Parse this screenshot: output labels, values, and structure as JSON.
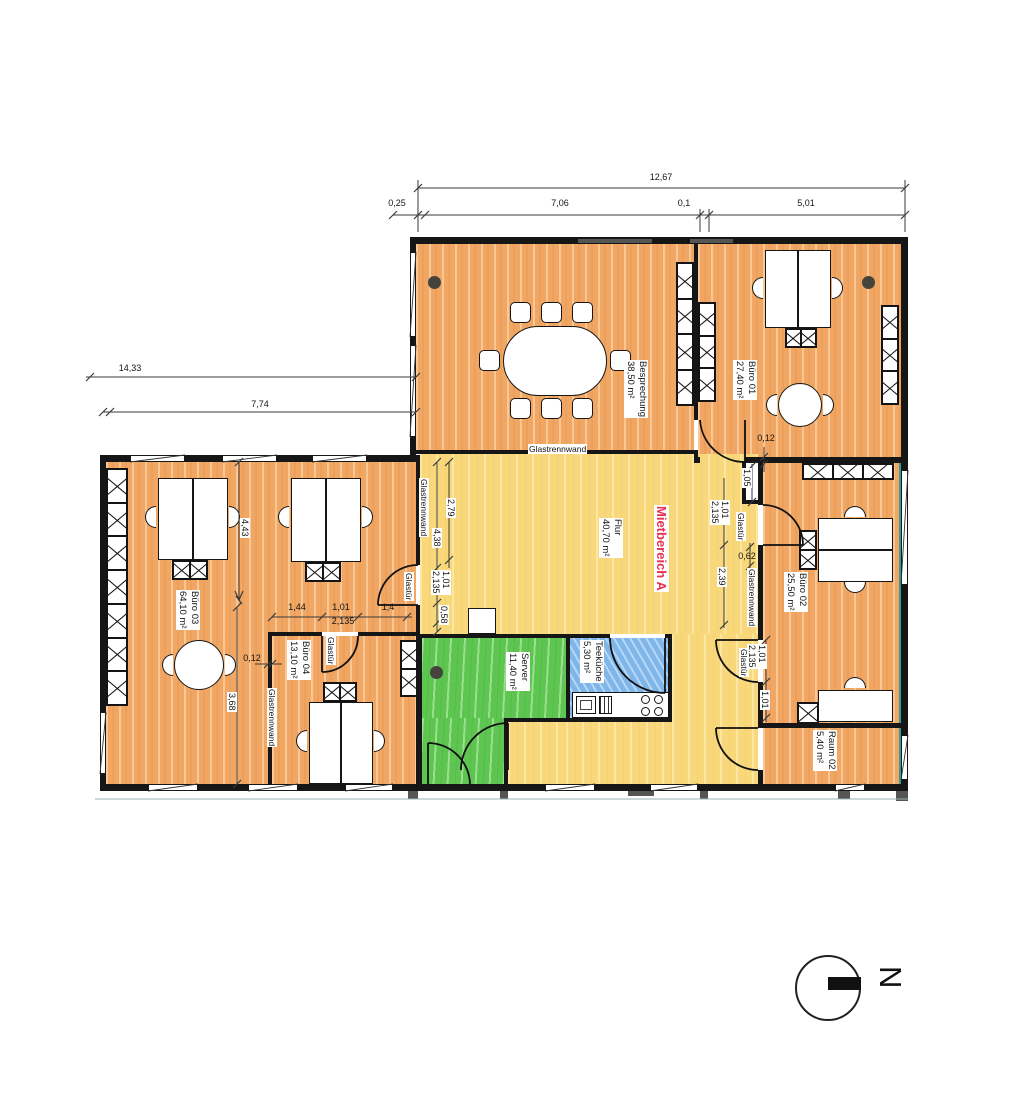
{
  "rooms": {
    "besprechung": {
      "name": "Besprechung",
      "area": "38,50 m²"
    },
    "buero01": {
      "name": "Büro 01",
      "area": "27,40 m²"
    },
    "buero02": {
      "name": "Büro 02",
      "area": "25,50 m²"
    },
    "buero03": {
      "name": "Büro 03",
      "area": "64,10 m²"
    },
    "buero04": {
      "name": "Büro 04",
      "area": "13,10 m²"
    },
    "flur": {
      "name": "Flur",
      "area": "40,70 m²"
    },
    "server": {
      "name": "Server",
      "area": "11,40 m²"
    },
    "teekueche": {
      "name": "Teeküche",
      "area": "5,30 m²"
    },
    "raum02": {
      "name": "Raum 02",
      "area": "5,40 m²"
    }
  },
  "zone": {
    "label": "Mietbereich A",
    "color": "#e63054"
  },
  "labels": {
    "glass_wall": "Glastrennwand",
    "glass_door": "Glastür"
  },
  "dims": {
    "top": {
      "total": "12,67",
      "segs": [
        "0,25",
        "7,06",
        "0,1",
        "5,01"
      ]
    },
    "left": [
      "14,33",
      "7,74"
    ],
    "flur_west": [
      "2,79",
      "4,38",
      "1,01",
      "2,135",
      "0,58"
    ],
    "flur_east": [
      "1,01",
      "2,135",
      "2,39"
    ],
    "niche": [
      "0,12",
      "1,05"
    ],
    "b02_west": [
      "0,62",
      "1,01",
      "2,135",
      "1,01"
    ],
    "left_block": {
      "vertical": [
        "4,43",
        "3,68"
      ],
      "wall": "0,12",
      "chain": [
        "1,44",
        "1,01",
        "2,135",
        "1,4"
      ]
    }
  },
  "north": {
    "label": "N"
  },
  "colors": {
    "office_orange": "#f1a763",
    "corridor_yellow": "#f8d87a",
    "server_green": "#5ec551",
    "kitchen_blue": "#7fb6e9",
    "wall_black": "#161616",
    "facade_teal": "#2f9e95",
    "zone_red": "#e63054"
  }
}
